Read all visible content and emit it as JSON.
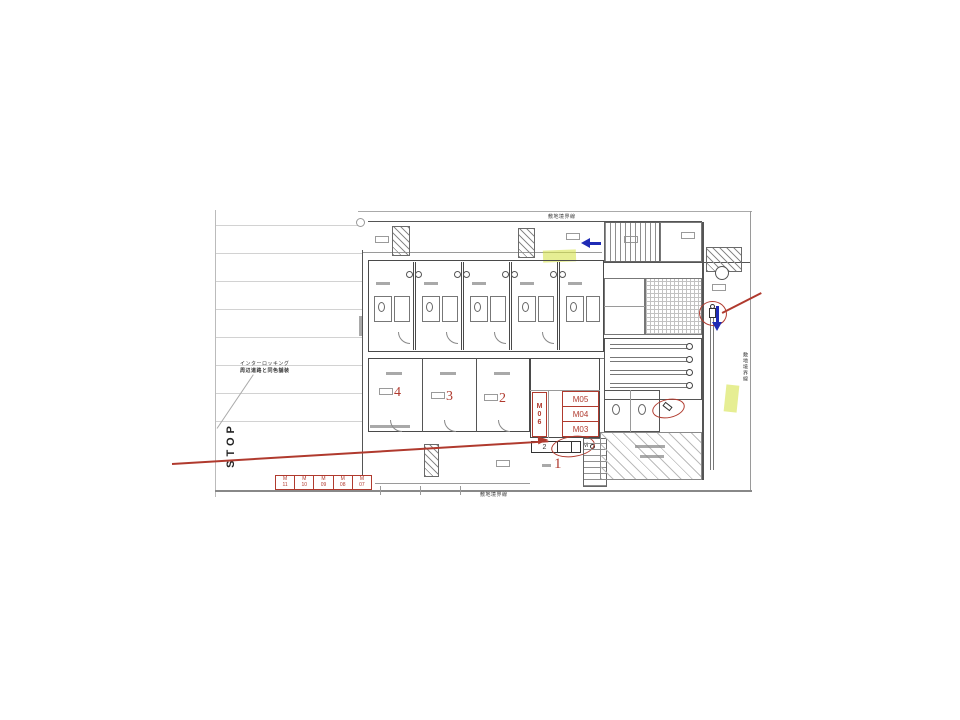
{
  "colors": {
    "annotation_red": "#b03a2e",
    "annotation_blue": "#1f2bb5",
    "highlight_yellow": "#d6e34b",
    "drawing_gray": "#555555"
  },
  "stop_marking": "STOP",
  "notes": {
    "interlocking_line1": "インターロッキング",
    "interlocking_line2": "周辺道路と同色舗装"
  },
  "boundaries": {
    "top": "敷地境界線",
    "bottom": "敷地境界線",
    "right": "敷地境界線"
  },
  "red_labels": {
    "m_vertical": "M06",
    "m_stack": [
      "M05",
      "M04",
      "M03"
    ],
    "room_numbers": [
      "4",
      "3",
      "2"
    ],
    "area_number": "1"
  },
  "meter_table": {
    "cells": [
      {
        "row1": "M",
        "row2": "11"
      },
      {
        "row1": "M",
        "row2": "10"
      },
      {
        "row1": "M",
        "row2": "09"
      },
      {
        "row1": "M",
        "row2": "08"
      },
      {
        "row1": "M",
        "row2": "07"
      }
    ]
  },
  "small_table": {
    "cell1": "2",
    "side_label": "M"
  }
}
